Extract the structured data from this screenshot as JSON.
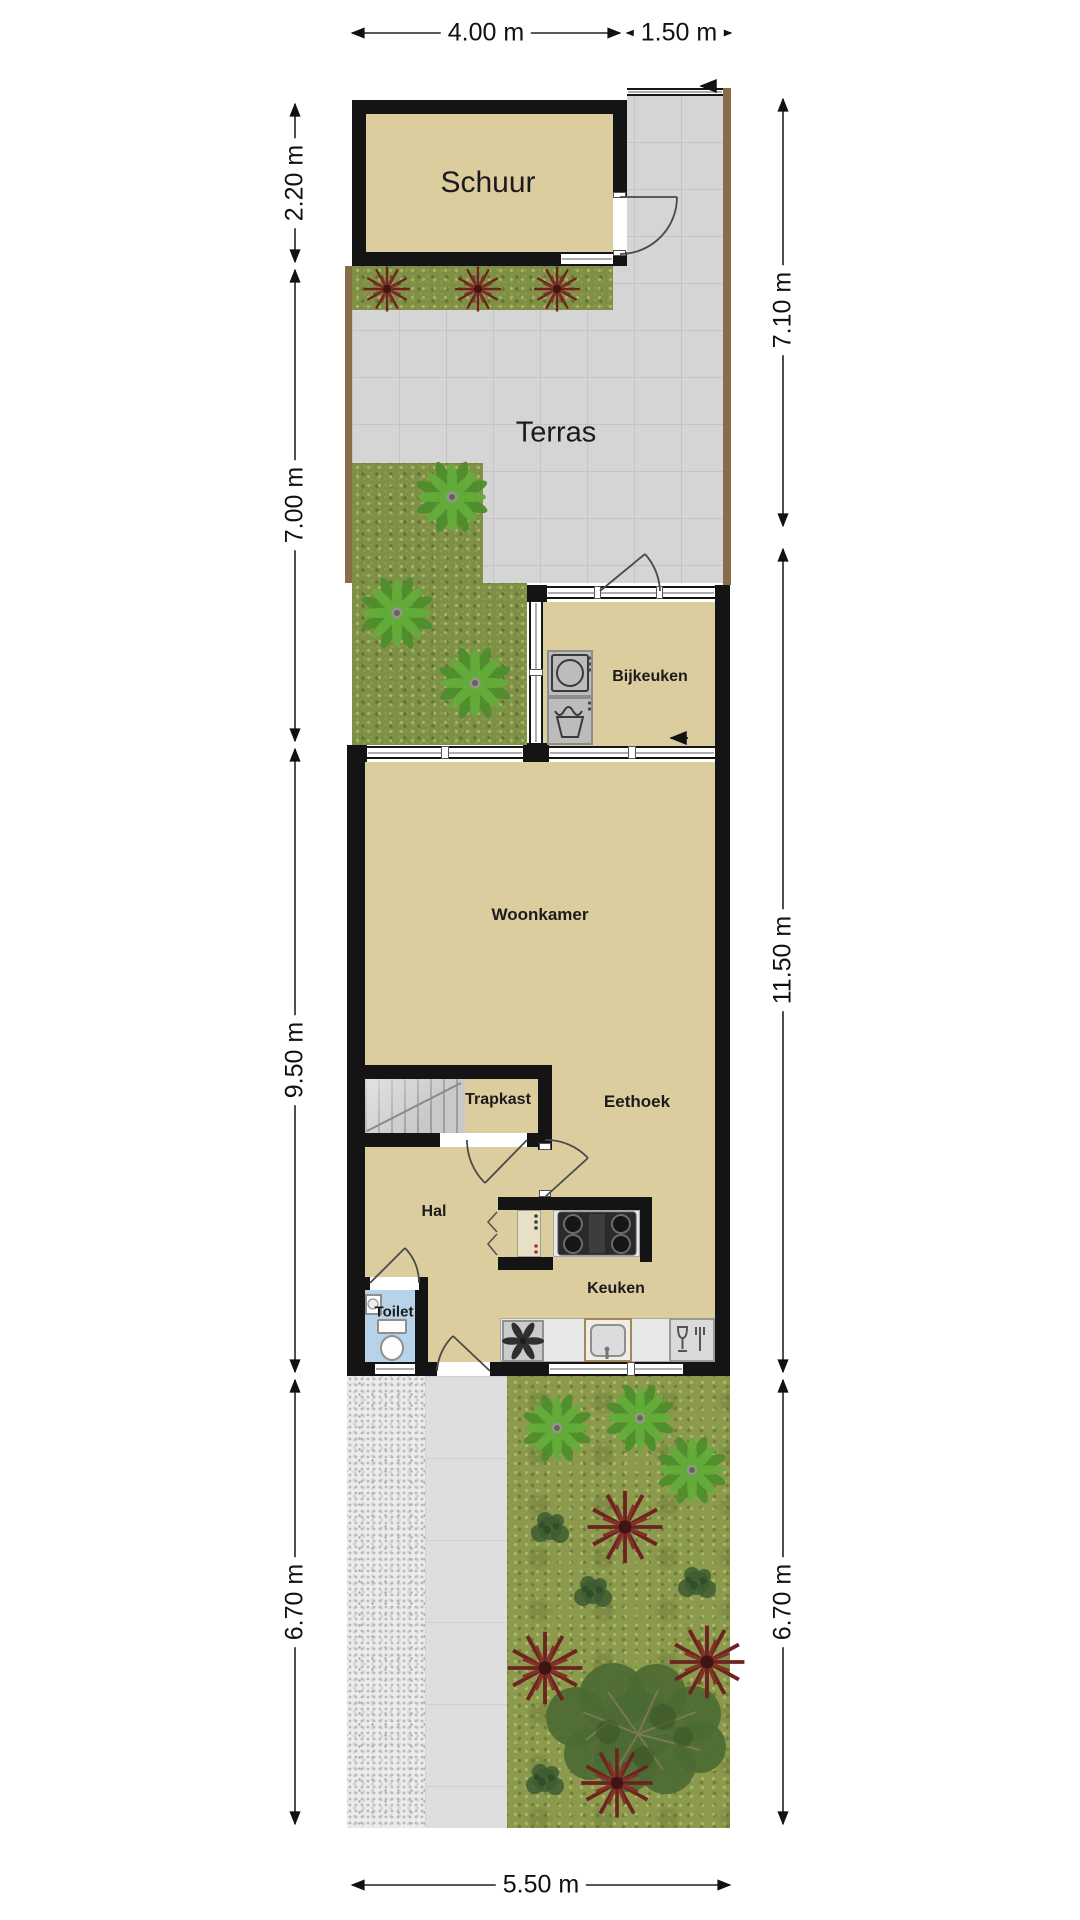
{
  "dims": {
    "top": [
      "4.00 m",
      "1.50 m"
    ],
    "left": [
      "2.20 m",
      "7.00 m",
      "9.50 m",
      "6.70 m"
    ],
    "right": [
      "7.10 m",
      "11.50 m",
      "6.70 m"
    ],
    "bottom": [
      "5.50 m"
    ]
  },
  "rooms": {
    "schuur": "Schuur",
    "terras": "Terras",
    "bijkeuken": "Bijkeuken",
    "woonkamer": "Woonkamer",
    "trapkast": "Trapkast",
    "eethoek": "Eethoek",
    "hal": "Hal",
    "toilet": "Toilet",
    "keuken": "Keuken"
  },
  "colors": {
    "floor": "#dccd9e",
    "wall": "#141414",
    "terrace": "#d5d5d5",
    "grass": "#7e9045",
    "garden_grass": "#8c9a4d",
    "toilet_floor": "#b7d3e9",
    "fence": "#8a6b48",
    "counter": "#e8e8e8",
    "plant_maroon": "#6d2420",
    "palm_green": "#5ea53b"
  }
}
